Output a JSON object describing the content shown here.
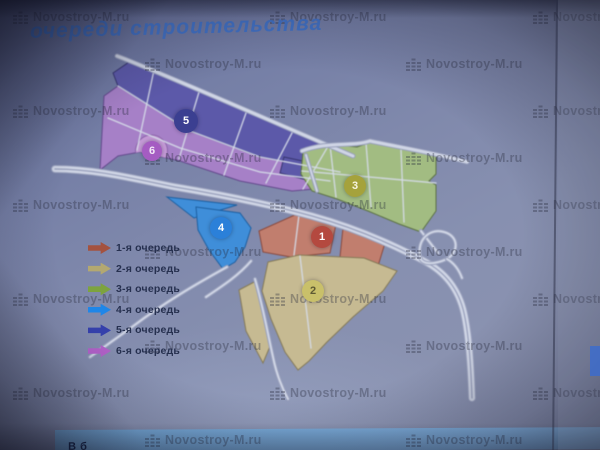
{
  "title": "очереди строительства",
  "watermark": {
    "text": "Novostroy-M.ru",
    "icon": "building-bars-icon"
  },
  "legend": {
    "label_color": "#26304f",
    "items": [
      {
        "phase": "1",
        "label": "1-я очередь",
        "arrow_color": "#a4523f"
      },
      {
        "phase": "2",
        "label": "2-я очередь",
        "arrow_color": "#b3a871"
      },
      {
        "phase": "3",
        "label": "3-я очередь",
        "arrow_color": "#7da33f"
      },
      {
        "phase": "4",
        "label": "4-я очередь",
        "arrow_color": "#1f86e8"
      },
      {
        "phase": "5",
        "label": "5-я очередь",
        "arrow_color": "#3540ab"
      },
      {
        "phase": "6",
        "label": "6-я очередь",
        "arrow_color": "#b261c9"
      }
    ]
  },
  "map": {
    "zones": [
      {
        "phase": "1",
        "name": "1-я очередь",
        "fill": "#c17e6e",
        "stroke": "#8a4a3e"
      },
      {
        "phase": "2",
        "name": "2-я очередь",
        "fill": "#c6ba92",
        "stroke": "#857a57"
      },
      {
        "phase": "3",
        "name": "3-я очередь",
        "fill": "#a2bc82",
        "stroke": "#5c7244"
      },
      {
        "phase": "4",
        "name": "4-я очередь",
        "fill": "#3f8ed9",
        "stroke": "#1d5fa0"
      },
      {
        "phase": "5",
        "name": "5-я очередь",
        "fill": "#5c59a9",
        "stroke": "#37356f"
      },
      {
        "phase": "6",
        "name": "6-я очередь",
        "fill": "#a680c7",
        "stroke": "#64498c"
      }
    ],
    "badges": [
      {
        "num": "1",
        "x": 322,
        "y": 237,
        "r": 11,
        "bg": "#b4493f",
        "fg": "#ffffff"
      },
      {
        "num": "2",
        "x": 313,
        "y": 291,
        "r": 11,
        "bg": "#c9c06a",
        "fg": "#5e5a33"
      },
      {
        "num": "3",
        "x": 355,
        "y": 186,
        "r": 11,
        "bg": "#a5a23c",
        "fg": "#f7f4e0"
      },
      {
        "num": "4",
        "x": 221,
        "y": 228,
        "r": 11,
        "bg": "#2b80d9",
        "fg": "#ffffff"
      },
      {
        "num": "5",
        "x": 186,
        "y": 121,
        "r": 12,
        "bg": "#3b3f91",
        "fg": "#ffffff"
      },
      {
        "num": "6",
        "x": 152,
        "y": 151,
        "r": 10,
        "bg": "#a55cc2",
        "fg": "#f2e8f7"
      }
    ]
  },
  "bottom_bar": {
    "partial_text": "В б",
    "color": "#79b1e2"
  }
}
